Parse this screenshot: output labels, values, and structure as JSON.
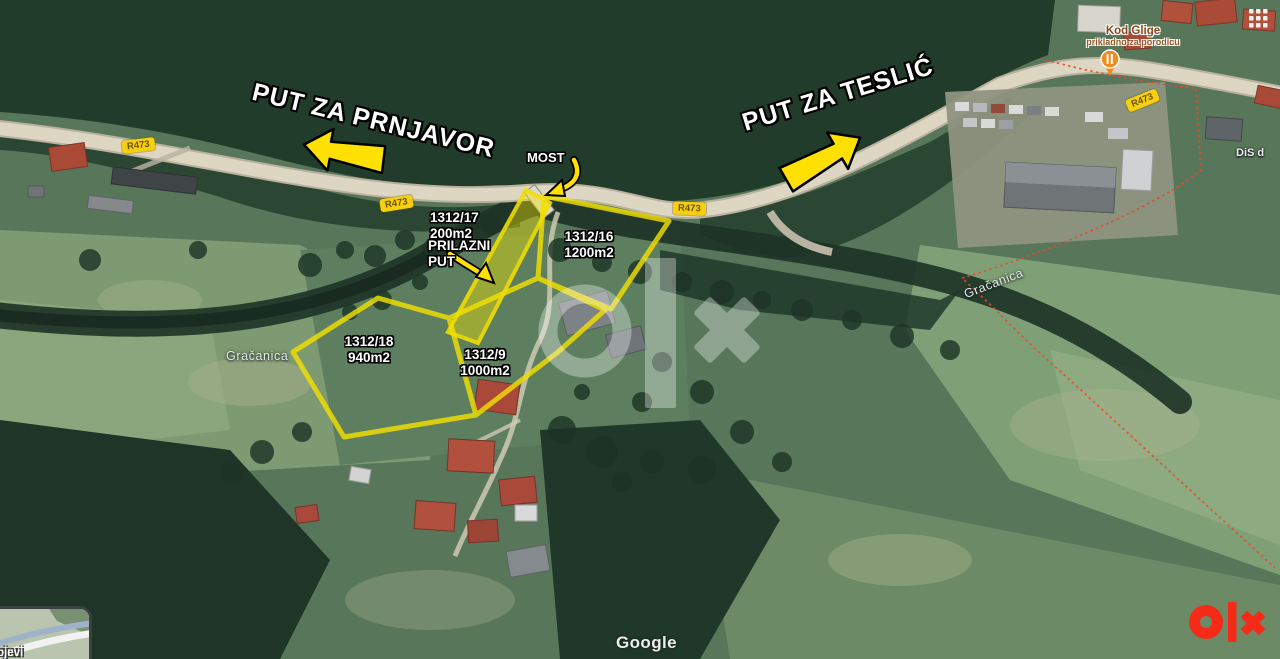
{
  "map": {
    "direction_labels": {
      "west": "PUT ZA PRNJAVOR",
      "east": "PUT ZA TESLIĆ"
    },
    "bridge_label": "MOST",
    "parcels": {
      "p17": {
        "id": "1312/17",
        "area": "200m2",
        "note_line1": "PRILAZNI",
        "note_line2": "PUT"
      },
      "p16": {
        "id": "1312/16",
        "area": "1200m2"
      },
      "p18": {
        "id": "1312/18",
        "area": "940m2"
      },
      "p9": {
        "id": "1312/9",
        "area": "1000m2"
      }
    },
    "river_label": "Gračanica",
    "poi": {
      "name": "Kod Glige",
      "subtitle": "prikladno za porodicu"
    },
    "business_label_partial": "DiS d",
    "road_badge": "R473",
    "minimap_label_partial": "ojevi",
    "attribution": "Google"
  },
  "watermark": {
    "brand": "olx"
  },
  "colors": {
    "annotation_yellow": "#f2df00",
    "boundary_red": "#e64a32",
    "olx_red": "#f52a17",
    "road_badge_yellow": "#f7cf0f"
  }
}
